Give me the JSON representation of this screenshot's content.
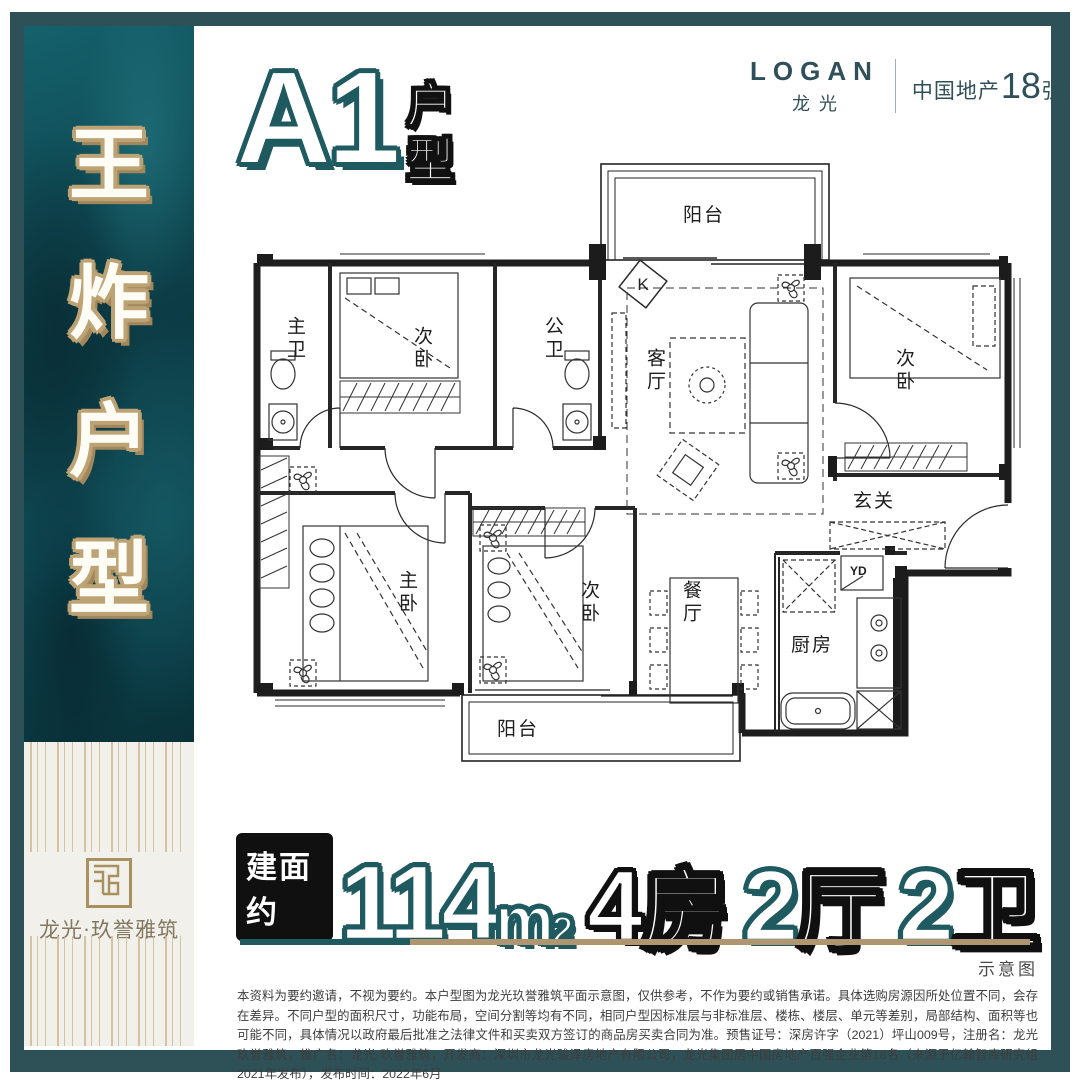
{
  "brand": {
    "logo_en": "LOGAN",
    "logo_cn": "龙光",
    "rank_prefix": "中国地产",
    "rank_number": "18",
    "rank_suffix": "强"
  },
  "sidebar": {
    "char_1": "王",
    "char_2": "炸",
    "char_3": "户",
    "char_4": "型",
    "project_name": "龙光·玖誉雅筑"
  },
  "unit_title": {
    "code": "A1",
    "suffix_char_1": "户",
    "suffix_char_2": "型"
  },
  "floorplan": {
    "balcony_top": "阳台",
    "master_bath": "主卫",
    "bedroom_top": "次卧",
    "public_bath": "公卫",
    "living": "客厅",
    "bedroom_right": "次卧",
    "foyer": "玄关",
    "master_bedroom": "主卧",
    "bedroom_mid": "次卧",
    "dining": "餐厅",
    "kitchen": "厨房",
    "laundry": "YD",
    "balcony_bottom": "阳台",
    "kitchen_mark": "K"
  },
  "stats": {
    "badge": "建面约",
    "area_number": "114",
    "area_unit": "m",
    "area_sup": "2",
    "rooms_number": "4",
    "rooms_label": "房",
    "halls_number": "2",
    "halls_label": "厅",
    "baths_number": "2",
    "baths_label": "卫"
  },
  "footnote": {
    "schematic_label": "示意图",
    "disclaimer": "本资料为要约邀请，不视为要约。本户型图为龙光玖誉雅筑平面示意图，仅供参考，不作为要约或销售承诺。具体选购房源因所处位置不同，会存在差异。不同户型的面积尺寸，功能布局，空间分割等均有不同，相同户型因标准层与非标准层、楼栋、楼层、单元等差别，局部结构、面积等也可能不同，具体情况以政府最后批准之法律文件和买卖双方签订的商品房买卖合同为准。预售证号：深房许字（2021）坪山009号，注册名：龙光玖誉雅筑，推广名：龙光·玖誉雅筑，开发商：深圳市龙光骏泽房地产有限公司，龙光集团居中国房地产百强企业第18名（来源于亿翰智库研究组2021年发布），发布时间：2022年6月"
  },
  "colors": {
    "teal_accent": "#1e5a60",
    "gold": "#b09770",
    "frame_teal": "#2d5156"
  }
}
